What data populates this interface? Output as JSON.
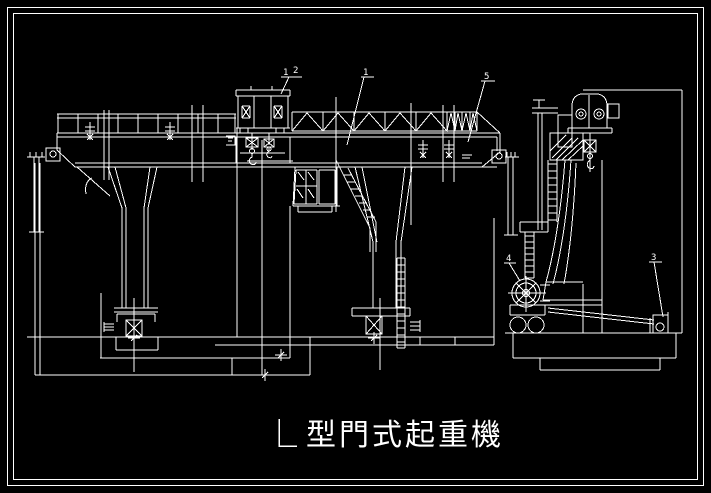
{
  "drawing": {
    "background_color": "#000000",
    "line_color": "#ffffff",
    "title": {
      "prefix_symbol": "L",
      "name": "型門式起重機",
      "full_title": "L 型門式起重機"
    },
    "callouts": {
      "label_1a": "1",
      "label_2": "2",
      "label_1b": "1",
      "label_5": "5",
      "label_4": "4",
      "label_3": "3"
    }
  }
}
